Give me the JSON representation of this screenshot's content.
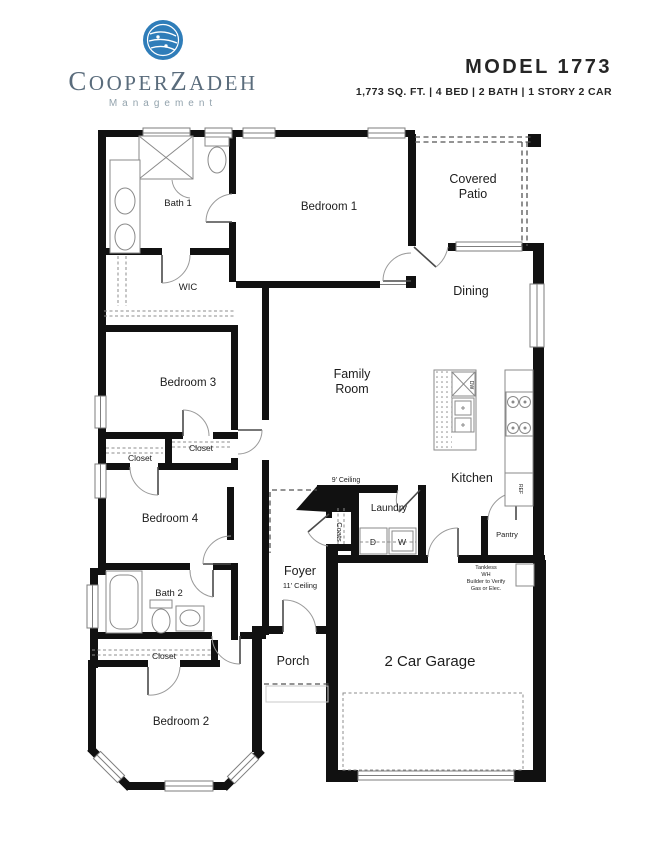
{
  "header": {
    "logo": {
      "seg1": "C",
      "seg2": "OOPER",
      "seg3": "Z",
      "seg4": "ADEH",
      "subtitle": "Management"
    },
    "model": {
      "title": "MODEL 1773",
      "specs": "1,773 SQ. FT. | 4 BED | 2 BATH | 1 STORY 2 CAR"
    }
  },
  "plan": {
    "rooms": {
      "bath1": "Bath 1",
      "bedroom1": "Bedroom 1",
      "patio_line1": "Covered",
      "patio_line2": "Patio",
      "dining": "Dining",
      "wic": "WIC",
      "bedroom3": "Bedroom 3",
      "family_line1": "Family",
      "family_line2": "Room",
      "kitchen": "Kitchen",
      "closet_bed3": "Closet",
      "closet_bed4": "Closet",
      "bedroom4": "Bedroom 4",
      "ceiling9": "9' Ceiling",
      "laundry": "Laundry",
      "coats": "Coats",
      "pantry": "Pantry",
      "bath2": "Bath 2",
      "foyer": "Foyer",
      "ceiling11": "11' Ceiling",
      "closet_bed2": "Closet",
      "porch": "Porch",
      "bedroom2": "Bedroom 2",
      "garage": "2 Car Garage"
    },
    "notes": {
      "wh_line1": "Tankless",
      "wh_line2": "WH",
      "wh_line3": "Builder to Verify",
      "wh_line4": "Gas or Elec."
    },
    "appliances": {
      "dryer": "D",
      "washer": "W",
      "fridge": "REF",
      "dishwasher": "DW"
    },
    "colors": {
      "wall": "#111111",
      "window_gray": "#7d7d7d",
      "logo_blue": "#2f7db9",
      "brand_gray": "#5a6c7c",
      "title_dark": "#262626"
    }
  }
}
